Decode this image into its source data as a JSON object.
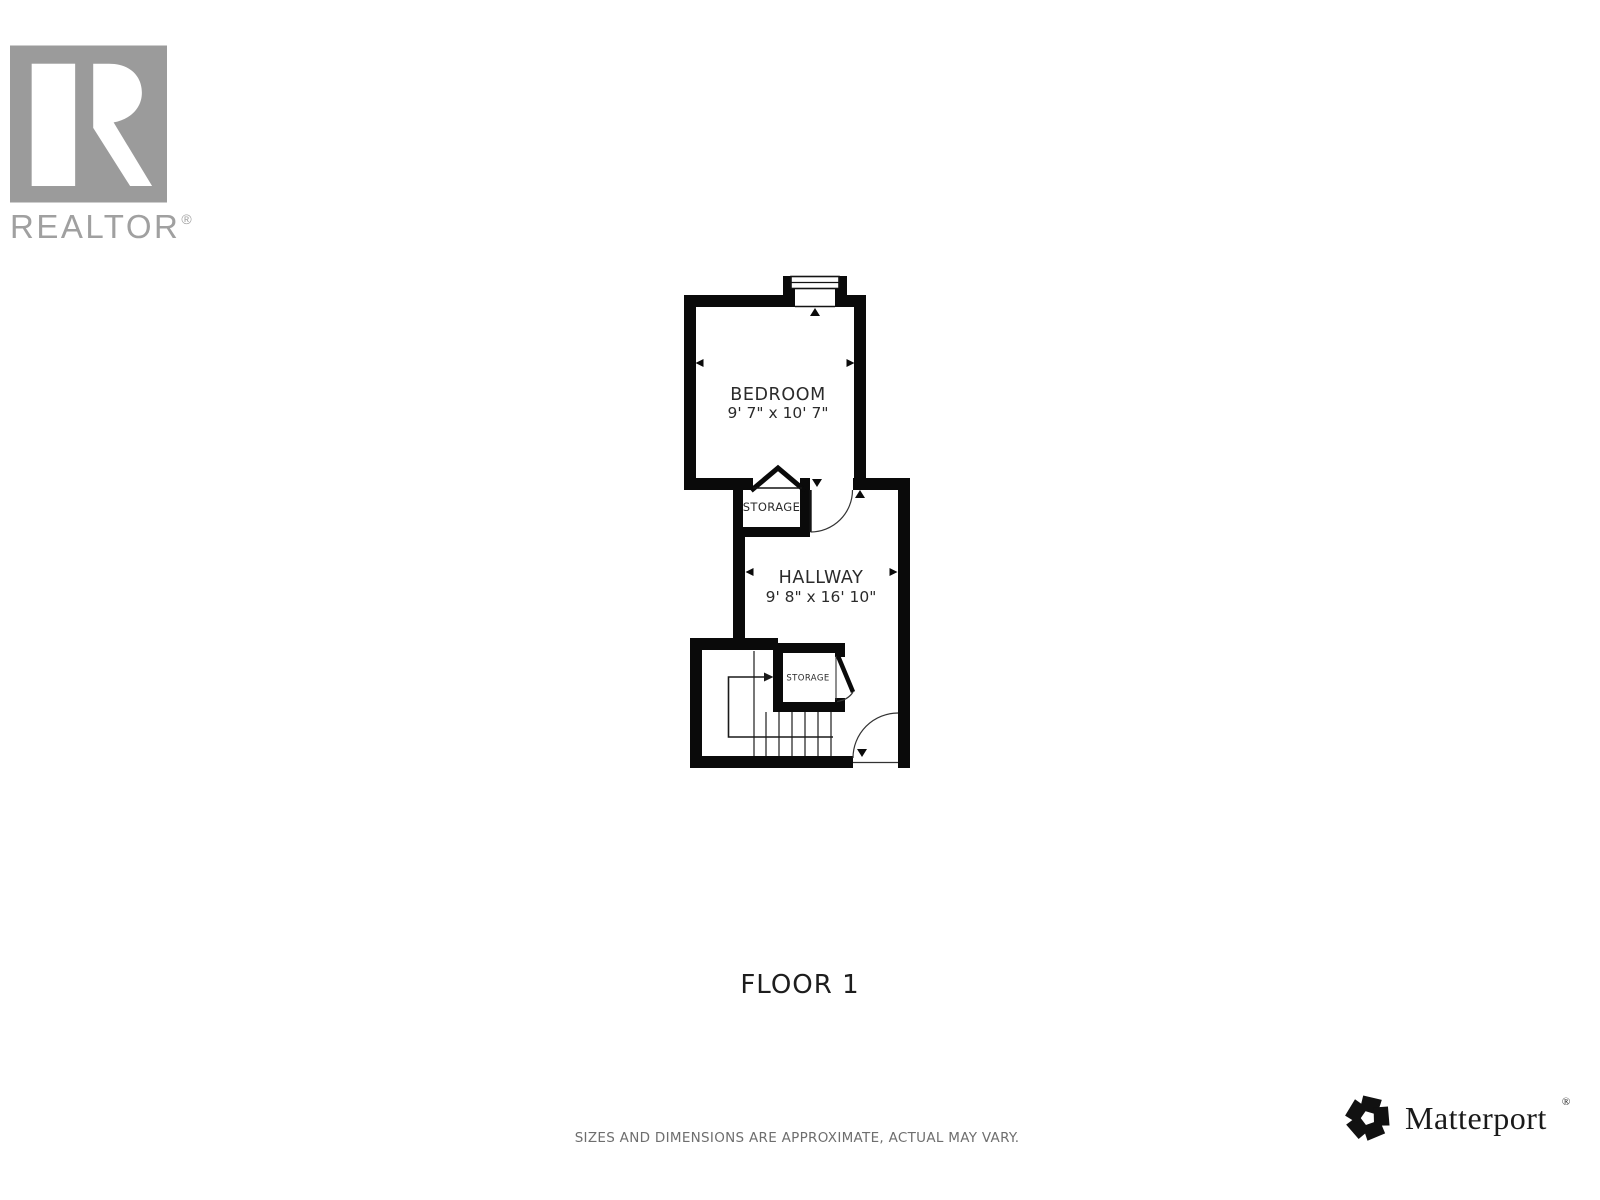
{
  "colors": {
    "wall_black": "#0a0a0a",
    "plan_text": "#2b2b2b",
    "realtor_gray": "#a0a0a0",
    "disclaimer_gray": "#6e6e6e",
    "matterport_black": "#1a1a1a"
  },
  "realtor_logo": {
    "wordmark": "REALTOR",
    "registered_mark": "®"
  },
  "floor_plan": {
    "floor_label": "FLOOR 1",
    "rooms": [
      {
        "name": "BEDROOM",
        "dimensions": "9' 7\" x 10' 7\""
      },
      {
        "name": "HALLWAY",
        "dimensions": "9' 8\" x 16' 10\""
      },
      {
        "name": "STORAGE"
      },
      {
        "name": "STORAGE"
      }
    ]
  },
  "footer": {
    "disclaimer": "SIZES AND DIMENSIONS ARE APPROXIMATE, ACTUAL MAY VARY."
  },
  "matterport_logo": {
    "wordmark": "Matterport",
    "registered_mark": "®"
  }
}
